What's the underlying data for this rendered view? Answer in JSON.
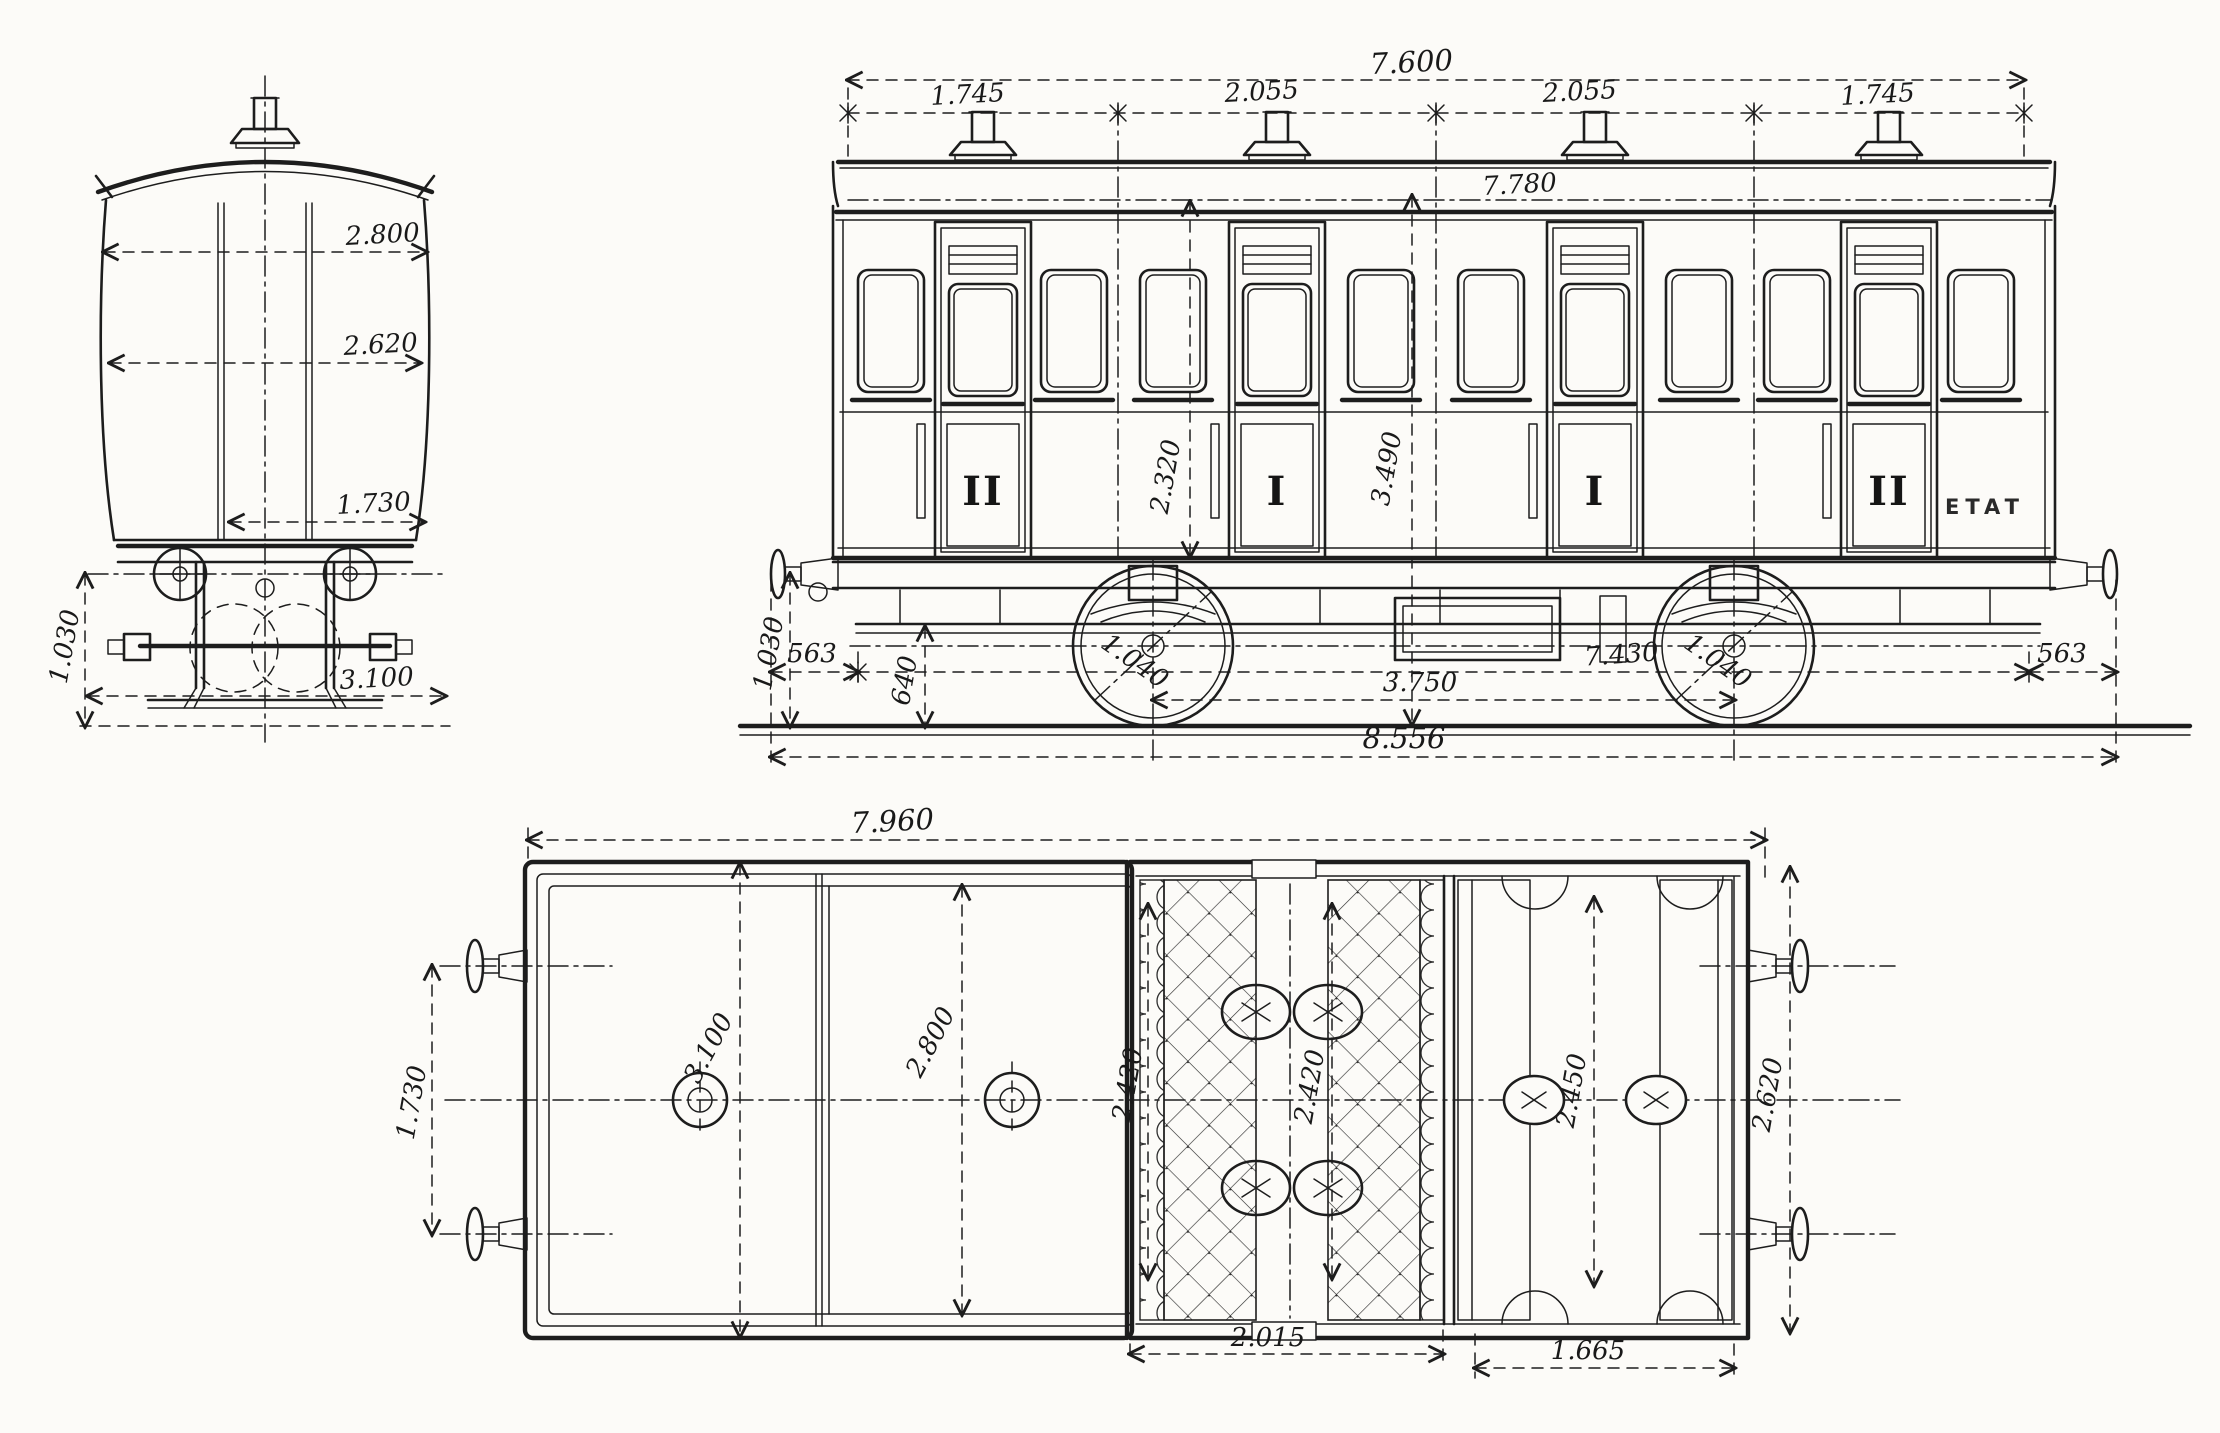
{
  "sheet": {
    "title": "railway-carriage-technical-drawing",
    "paper_color": "#fcfbf8",
    "ink_color": "#1d1d1d"
  },
  "end_view": {
    "name": "end-elevation",
    "dims": {
      "width_top": "2.800",
      "width_mid": "2.620",
      "width_lower": "1.730",
      "buffer_height": "1.030",
      "base_width": "3.100"
    }
  },
  "side_view": {
    "name": "side-elevation",
    "dims": {
      "vent_chain_total": "7.600",
      "bay_1": "1.745",
      "bay_2": "2.055",
      "bay_3": "2.055",
      "bay_4": "1.745",
      "body_length": "7.780",
      "door_height": "2.320",
      "body_height": "3.490",
      "buffer_height": "1.030",
      "overhang_left": "563",
      "step_height": "640",
      "wheel_dia_left": "1.040",
      "frame_length": "7.430",
      "wheel_dia_right": "1.040",
      "wheelbase": "3.750",
      "overhang_right": "563",
      "overall_length": "8.556"
    },
    "class_labels": [
      "II",
      "I",
      "I",
      "II"
    ],
    "owner_mark": "ETAT"
  },
  "plan_view": {
    "name": "roof-and-interior-plan",
    "dims": {
      "roof_length": "7.960",
      "buffer_spacing": "1.730",
      "roof_width": "3.100",
      "body_width": "2.800",
      "compartment_first_width_a": "2.420",
      "compartment_first_width_b": "2.420",
      "compartment_second_width": "2.450",
      "body_width_right": "2.620",
      "compartment_first_length": "2.015",
      "compartment_second_length": "1.665"
    }
  }
}
